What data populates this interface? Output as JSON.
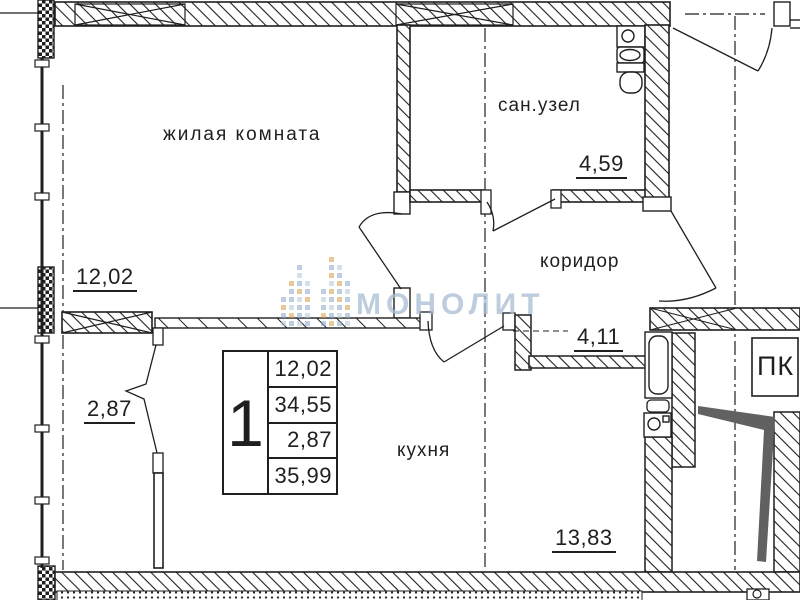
{
  "labels": {
    "living_room": "жилая комната",
    "living_area": "12,02",
    "bathroom": "сан.узел",
    "bathroom_area": "4,59",
    "corridor": "коридор",
    "corridor_area": "4,11",
    "kitchen": "кухня",
    "kitchen_area": "13,83",
    "balcony_area": "2,87",
    "stairwell": "ПК"
  },
  "stamp": {
    "rooms_count": "1",
    "living_area": "12,02",
    "apartment_area": "34,55",
    "balcony_area": "2,87",
    "total_area": "35,99"
  },
  "watermark": {
    "text": "МОНОЛИТ"
  },
  "colors": {
    "line": "#1f1f1f",
    "wedge": "#616161",
    "watermark": "#a9bdd3"
  }
}
